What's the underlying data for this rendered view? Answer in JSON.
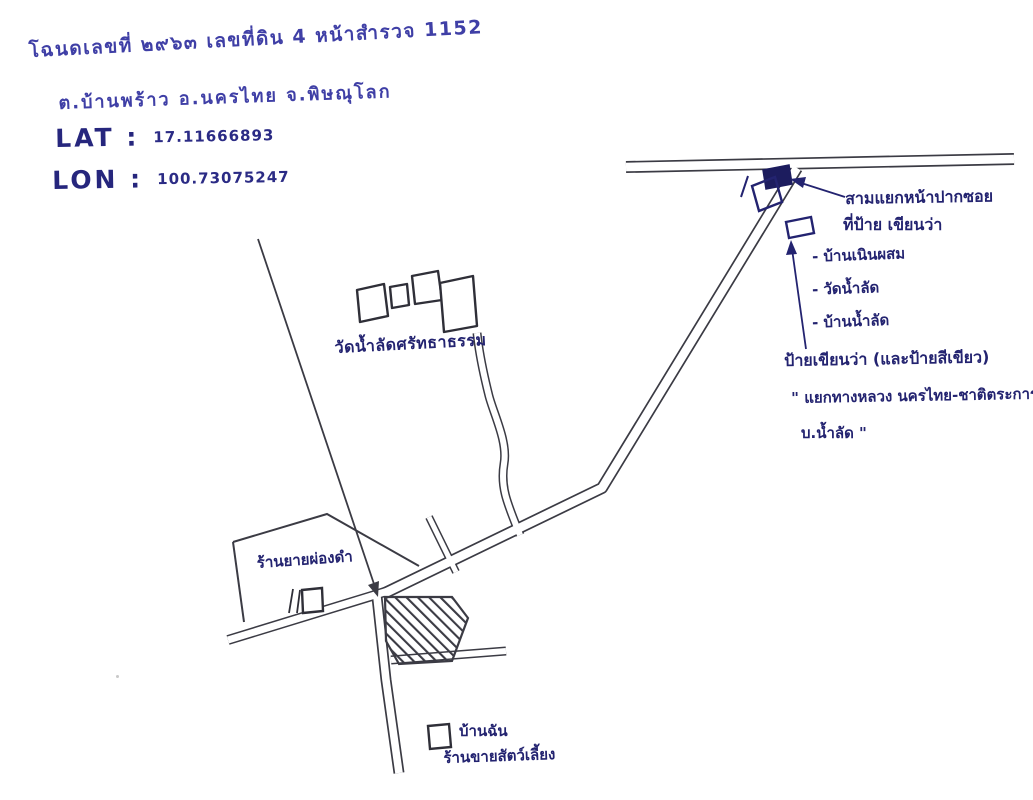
{
  "document": {
    "deed_line": "โฉนดเลขที่ ๒๙๖๓ เลขที่ดิน 4 หน้าสำรวจ 1152",
    "address_line": "ต.บ้านพร้าว อ.นครไทย จ.พิษณุโลก",
    "lat_label": "LAT :",
    "lat_value": "17.11666893",
    "lon_label": "LON :",
    "lon_value": "100.73075247"
  },
  "map": {
    "labels": {
      "temple": "วัดน้ำลัดศรัทธาธรรม",
      "shop": "ร้านยายผ่องดำ",
      "my_house": "บ้านฉัน",
      "my_house_sub": "ร้านขายสัตว์เลี้ยง",
      "junction_note_1": "สามแยกหน้าปากซอย",
      "junction_note_2": "ที่ป้าย เขียนว่า",
      "sign_items": [
        "- บ้านเนินผสม",
        "- วัดน้ำลัด",
        "- บ้านน้ำลัด"
      ],
      "green_sign_note": "ป้ายเขียนว่า (และป้ายสีเขียว)",
      "green_sign_quote_1": "\" แยกทางหลวง นครไทย-ชาติตระการ-",
      "green_sign_quote_2": "บ.น้ำลัด \""
    },
    "colors": {
      "ink_blue": "#3f3fa6",
      "ink_navy": "#232370",
      "line_dark": "#3b3b44",
      "sign_fill": "#1c1c5e",
      "paper": "#ffffff"
    }
  }
}
